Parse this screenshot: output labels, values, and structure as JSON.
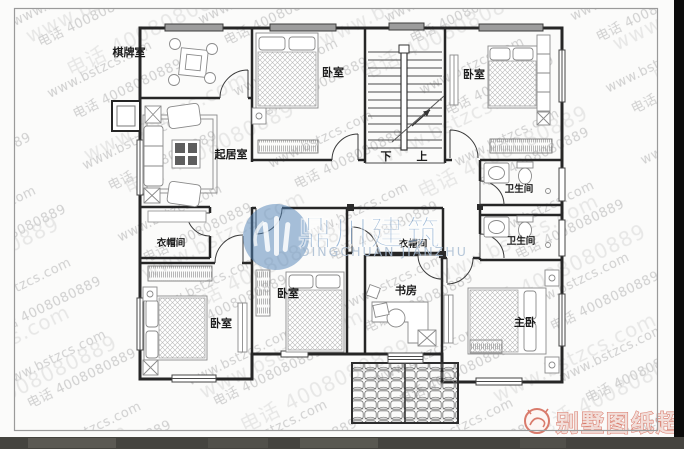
{
  "plan": {
    "rooms": [
      {
        "id": "game-room",
        "label": "棋牌室"
      },
      {
        "id": "bedroom-top-middle",
        "label": "卧室"
      },
      {
        "id": "bedroom-top-right",
        "label": "卧室"
      },
      {
        "id": "living-room",
        "label": "起居室"
      },
      {
        "id": "bathroom-upper",
        "label": "卫生间"
      },
      {
        "id": "bathroom-lower",
        "label": "卫生间"
      },
      {
        "id": "cloakroom-left",
        "label": "衣帽间"
      },
      {
        "id": "cloakroom-right",
        "label": "衣帽间"
      },
      {
        "id": "bedroom-bottom-left",
        "label": "卧室"
      },
      {
        "id": "bedroom-bottom-middle",
        "label": "卧室"
      },
      {
        "id": "study",
        "label": "书房"
      },
      {
        "id": "master-bedroom",
        "label": "主卧"
      }
    ],
    "stairs": {
      "down_label": "下",
      "up_label": "上"
    }
  },
  "watermark": {
    "site": "www.bstzcs.com",
    "phone": "电话 4008080889"
  },
  "center_logo": {
    "name_cn": "鼎川建筑",
    "name_en": "DINGCHUAN JIANZHU"
  },
  "brand_badge": {
    "label": "别墅图纸超市"
  },
  "colors": {
    "logo_blue": "#4f81b6",
    "logo_text_blue": "#4e82bb",
    "brand_red": "#d97b6c",
    "watermark_gray": "#c8c8c8"
  }
}
